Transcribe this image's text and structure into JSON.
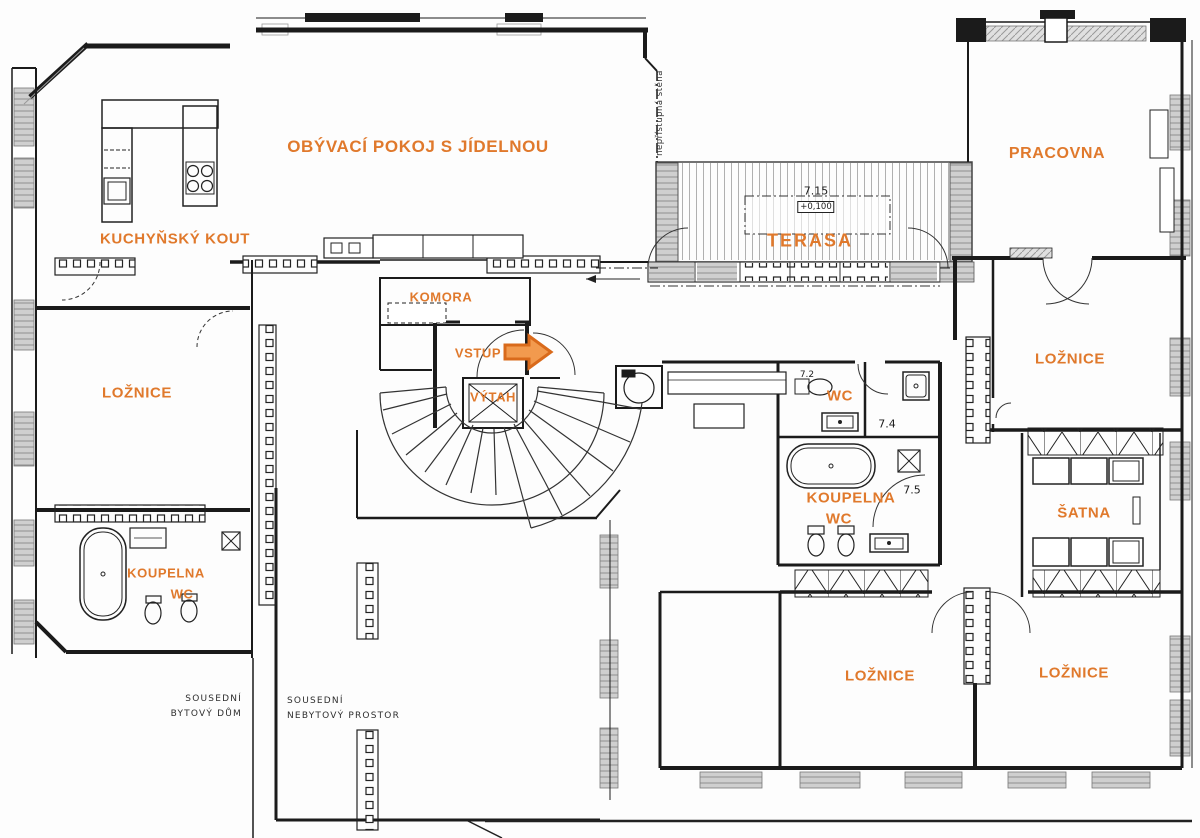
{
  "colors": {
    "label_orange": "#E0792C",
    "wall_black": "#1b1b1b",
    "window_gray": "#d2d2d2",
    "note_gray": "#2e2e2e"
  },
  "plan": {
    "rooms": {
      "living_room": "OBÝVACÍ POKOJ S JÍDELNOU",
      "kitchenette": "KUCHYŇSKÝ KOUT",
      "pantry": "KOMORA",
      "entrance": "VSTUP",
      "elevator": "VÝTAH",
      "terrace": "TERASA",
      "study": "PRACOVNA",
      "bedroom_left": "LOŽNICE",
      "bedroom_right": "LOŽNICE",
      "bedroom_bottom_left": "LOŽNICE",
      "bedroom_bottom_right": "LOŽNICE",
      "wc": "WC",
      "bathroom_right_line1": "KOUPELNA",
      "bathroom_right_line2": "WC",
      "walk_in_closet": "ŠATNA",
      "bathroom_left_line1": "KOUPELNA",
      "bathroom_left_line2": "WC"
    },
    "numbers": {
      "terrace_area": "7.15",
      "terrace_elevation": "+0,100",
      "wc_number": "7.2",
      "shower_room_number": "7.4",
      "bathroom_number": "7.5"
    },
    "notes": {
      "inaccessible_wall": "nepřístupná stěna",
      "neighbor_residential_line1": "SOUSEDNÍ",
      "neighbor_residential_line2": "BYTOVÝ DŮM",
      "neighbor_nonresidential_line1": "SOUSEDNÍ",
      "neighbor_nonresidential_line2": "NEBYTOVÝ PROSTOR"
    }
  }
}
